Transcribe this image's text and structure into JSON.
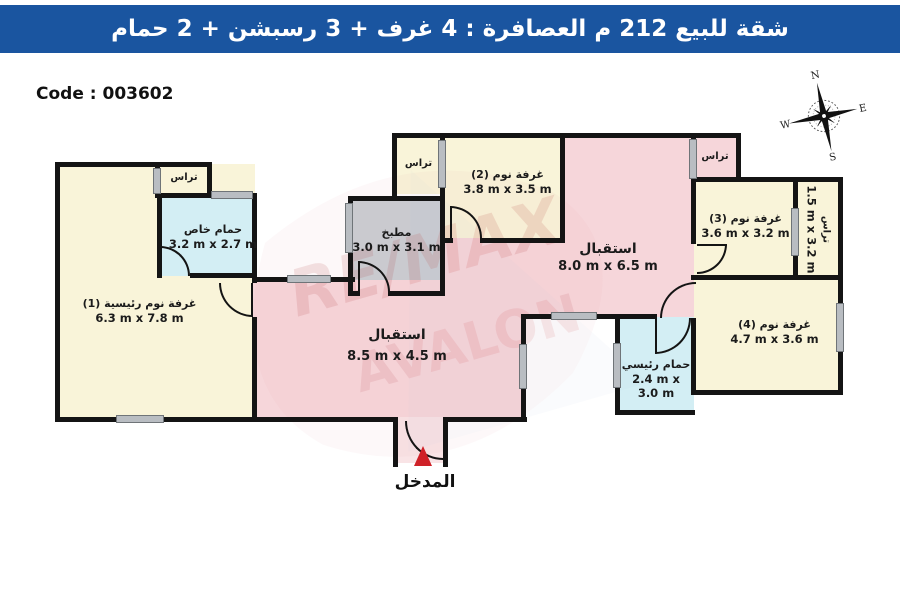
{
  "header": {
    "title": "شقة للبيع 212 م العصافرة :  4 غرف + 3 رسبشن + 2 حمام",
    "bg_color": "#1a55a0"
  },
  "code_label": "Code : 003602",
  "compass": {
    "n": "N",
    "e": "E",
    "s": "S",
    "w": "W"
  },
  "rooms": {
    "master_bedroom": {
      "name": "غرفة نوم رئيسية (1)",
      "dims": "6.3 m x 7.8 m",
      "color": "#f9f4d9"
    },
    "private_bath": {
      "name": "حمام خاص",
      "dims": "3.2 m x 2.7 m",
      "color": "#d3eef4"
    },
    "terrace_master": {
      "name": "تراس"
    },
    "kitchen": {
      "name": "مطبخ",
      "dims": "3.0 m x 3.1 m",
      "color": "#c9ced3"
    },
    "terrace_kitchen": {
      "name": "تراس"
    },
    "bedroom2": {
      "name": "غرفة نوم (2)",
      "dims": "3.8 m x 3.5 m",
      "color": "#f9f4d9"
    },
    "reception1": {
      "name": "استقبال",
      "dims": "8.5 m x 4.5 m",
      "color": "#f6d6da"
    },
    "reception2": {
      "name": "استقبال",
      "dims": "8.0 m x 6.5 m",
      "color": "#f6d6da"
    },
    "terrace_reception": {
      "name": "تراس"
    },
    "bedroom3": {
      "name": "غرفة نوم (3)",
      "dims": "3.6 m x 3.2 m",
      "color": "#f9f4d9"
    },
    "terrace_side": {
      "name": "تراس",
      "dims": "1.5 m x 3.2 m",
      "color": "#f9f4d9"
    },
    "bedroom4": {
      "name": "غرفة نوم (4)",
      "dims": "4.7 m x 3.6 m",
      "color": "#f9f4d9"
    },
    "main_bath": {
      "name": "حمام رئيسي",
      "dims": "2.4 m x 3.0 m",
      "color": "#d3eef4"
    }
  },
  "entrance": {
    "label": "المدخل",
    "arrow_color": "#cf2128"
  },
  "watermark": {
    "line1": "RE/MAX",
    "line2": "AVALON"
  }
}
